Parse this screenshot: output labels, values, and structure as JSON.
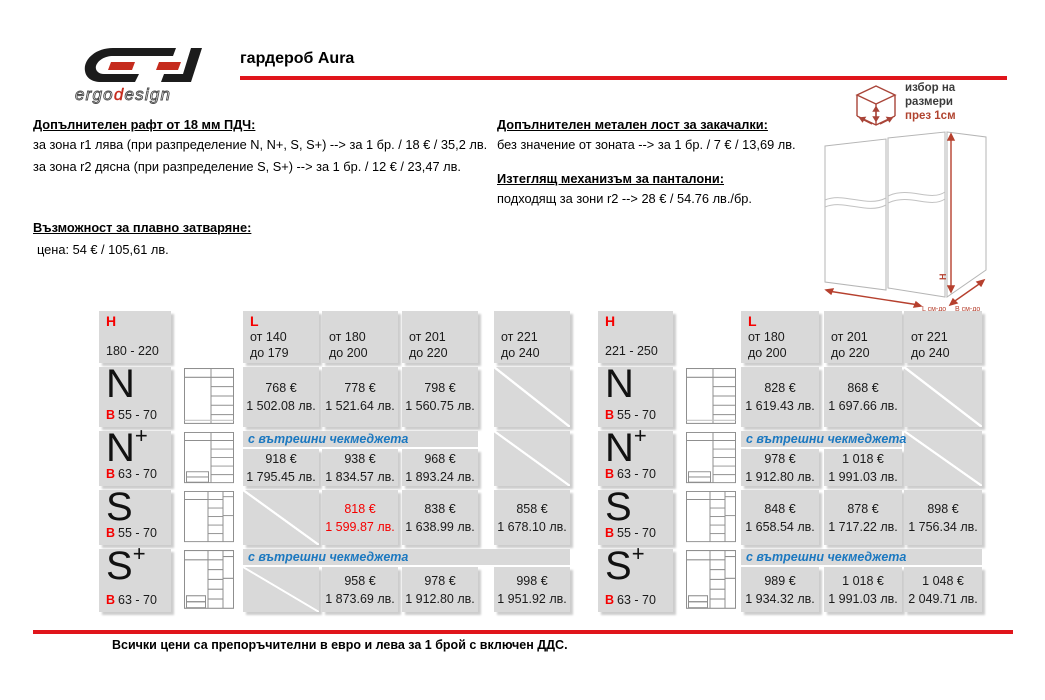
{
  "brand": {
    "logo_word_1": "ergo",
    "logo_word_2": "d",
    "logo_word_3": "esign"
  },
  "title": "гардероб Aura",
  "options_left": {
    "heading1": "Допълнителен рафт от 18 мм ПДЧ:",
    "line1": "за зона r1 лява (при разпределение N, N+, S, S+) -->  за 1 бр.  / 18 € / 35,2 лв.",
    "line2": "за зона r2 дясна (при разпределение S, S+) --> за 1 бр.  / 12 € / 23,47 лв.",
    "heading2": "Възможност за плавно затваряне:",
    "line3": "цена:  54 € / 105,61 лв."
  },
  "options_right": {
    "heading1": "Допълнителен метален лост за закачалки:",
    "line1": "без значение от зоната --> за 1 бр.  / 7 € / 13,69 лв.",
    "heading2": "Изтеглящ механизъм за панталони:",
    "line2": "подходящ за зони r2  --> 28 € / 54.76 лв./бр."
  },
  "size_selector": {
    "line1": "избор на",
    "line2": "размери",
    "line3": "през 1см"
  },
  "diagram_labels": {
    "h": "H",
    "l": "L см-до",
    "b": "B см-до"
  },
  "footer": "Всички цени са препоръчителни в евро и лева за 1 брой с включен ДДС.",
  "colors": {
    "accent_red": "#e0151b",
    "cell_gray": "#d9d9d9",
    "note_blue": "#1b78c0",
    "price_red": "#f50000"
  },
  "table1": {
    "h_label": "H",
    "h_range": "180 - 220",
    "l_label": "L",
    "columns": [
      {
        "from": "от 140",
        "to": "до 179"
      },
      {
        "from": "от 180",
        "to": "до 200"
      },
      {
        "from": "от 201",
        "to": "до 220"
      },
      {
        "from": "от 221",
        "to": "до 240"
      }
    ],
    "rows": [
      {
        "model": "N",
        "sup": "",
        "b": "В",
        "b_range": "55 - 70",
        "cells": [
          {
            "eur": "768 €",
            "bgn": "1 502.08 лв."
          },
          {
            "eur": "778 €",
            "bgn": "1 521.64 лв."
          },
          {
            "eur": "798 €",
            "bgn": "1 560.75 лв."
          }
        ]
      },
      {
        "model": "N",
        "sup": "+",
        "b": "В",
        "b_range": "63 - 70",
        "note": "с вътрешни чекмеджета",
        "cells": [
          {
            "eur": "918 €",
            "bgn": "1 795.45 лв."
          },
          {
            "eur": "938 €",
            "bgn": "1 834.57 лв."
          },
          {
            "eur": "968 €",
            "bgn": "1 893.24 лв."
          }
        ]
      },
      {
        "model": "S",
        "sup": "",
        "b": "В",
        "b_range": "55 - 70",
        "cells": [
          {
            "eur": "818 €",
            "bgn": "1 599.87 лв."
          },
          {
            "eur": "838 €",
            "bgn": "1 638.99 лв."
          },
          {
            "eur": "858 €",
            "bgn": "1 678.10 лв."
          }
        ]
      },
      {
        "model": "S",
        "sup": "+",
        "b": "В",
        "b_range": "63 - 70",
        "note": "с вътрешни чекмеджета",
        "cells": [
          {
            "eur": "958 €",
            "bgn": "1 873.69 лв."
          },
          {
            "eur": "978 €",
            "bgn": "1 912.80 лв."
          },
          {
            "eur": "998 €",
            "bgn": "1 951.92 лв."
          }
        ]
      }
    ]
  },
  "table2": {
    "h_label": "H",
    "h_range": "221 - 250",
    "l_label": "L",
    "columns": [
      {
        "from": "от 180",
        "to": "до 200"
      },
      {
        "from": "от 201",
        "to": "до 220"
      },
      {
        "from": "от 221",
        "to": "до 240"
      }
    ],
    "rows": [
      {
        "model": "N",
        "sup": "",
        "b": "В",
        "b_range": "55 - 70",
        "cells": [
          {
            "eur": "828 €",
            "bgn": "1 619.43 лв."
          },
          {
            "eur": "868 €",
            "bgn": "1 697.66 лв."
          }
        ]
      },
      {
        "model": "N",
        "sup": "+",
        "b": "В",
        "b_range": "63 - 70",
        "note": "с вътрешни чекмеджета",
        "cells": [
          {
            "eur": "978 €",
            "bgn": "1 912.80 лв."
          },
          {
            "eur": "1 018 €",
            "bgn": "1 991.03 лв."
          }
        ]
      },
      {
        "model": "S",
        "sup": "",
        "b": "В",
        "b_range": "55 - 70",
        "cells": [
          {
            "eur": "848 €",
            "bgn": "1 658.54 лв."
          },
          {
            "eur": "878 €",
            "bgn": "1 717.22 лв."
          },
          {
            "eur": "898 €",
            "bgn": "1 756.34 лв."
          }
        ]
      },
      {
        "model": "S",
        "sup": "+",
        "b": "В",
        "b_range": "63 - 70",
        "note": "с вътрешни чекмеджета",
        "cells": [
          {
            "eur": "989 €",
            "bgn": "1 934.32 лв."
          },
          {
            "eur": "1 018 €",
            "bgn": "1 991.03 лв."
          },
          {
            "eur": "1 048 €",
            "bgn": "2 049.71 лв."
          }
        ]
      }
    ]
  }
}
